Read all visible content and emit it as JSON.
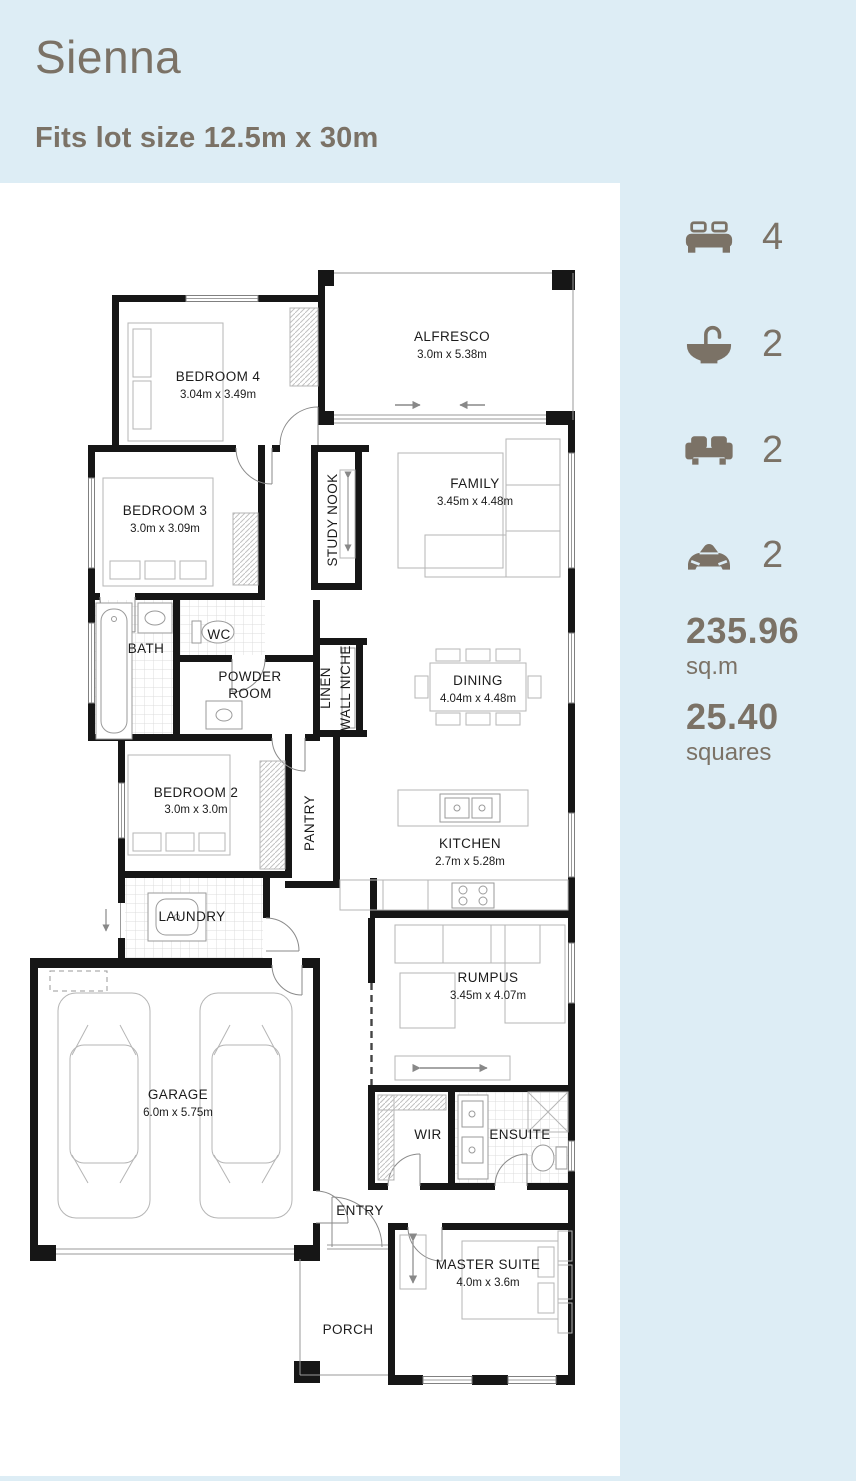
{
  "header": {
    "title": "Sienna",
    "subtitle": "Fits lot size 12.5m x 30m"
  },
  "stats": {
    "items": [
      {
        "icon": "bed-icon",
        "label": "bedrooms",
        "value": "4"
      },
      {
        "icon": "bath-icon",
        "label": "bathrooms",
        "value": "2"
      },
      {
        "icon": "sofa-icon",
        "label": "living-areas",
        "value": "2"
      },
      {
        "icon": "car-icon",
        "label": "car-spaces",
        "value": "2"
      }
    ],
    "area": {
      "value": "235.96",
      "unit": "sq.m"
    },
    "squares": {
      "value": "25.40",
      "unit": "squares"
    }
  },
  "plan": {
    "rooms": [
      {
        "name": "BEDROOM 4",
        "dims": "3.04m x 3.49m"
      },
      {
        "name": "ALFRESCO",
        "dims": "3.0m x 5.38m"
      },
      {
        "name": "BEDROOM 3",
        "dims": "3.0m x 3.09m"
      },
      {
        "name": "STUDY NOOK"
      },
      {
        "name": "FAMILY",
        "dims": "3.45m x 4.48m"
      },
      {
        "name": "BATH"
      },
      {
        "name": "WC"
      },
      {
        "name": "POWDER ROOM",
        "lines": [
          "POWDER",
          "ROOM"
        ]
      },
      {
        "name": "LINEN"
      },
      {
        "name": "WALL NICHE"
      },
      {
        "name": "DINING",
        "dims": "4.04m x 4.48m"
      },
      {
        "name": "BEDROOM 2",
        "dims": "3.0m x 3.0m"
      },
      {
        "name": "PANTRY"
      },
      {
        "name": "KITCHEN",
        "dims": "2.7m x 5.28m"
      },
      {
        "name": "LAUNDRY"
      },
      {
        "name": "RUMPUS",
        "dims": "3.45m x 4.07m"
      },
      {
        "name": "GARAGE",
        "dims": "6.0m x 5.75m"
      },
      {
        "name": "WIR"
      },
      {
        "name": "ENSUITE"
      },
      {
        "name": "ENTRY"
      },
      {
        "name": "MASTER SUITE",
        "dims": "4.0m x 3.6m"
      },
      {
        "name": "PORCH"
      }
    ]
  },
  "colors": {
    "accent_text": "#7b7266",
    "panel_blue": "#ddedf5",
    "plan_background": "#ffffff",
    "wall": "#161616"
  }
}
